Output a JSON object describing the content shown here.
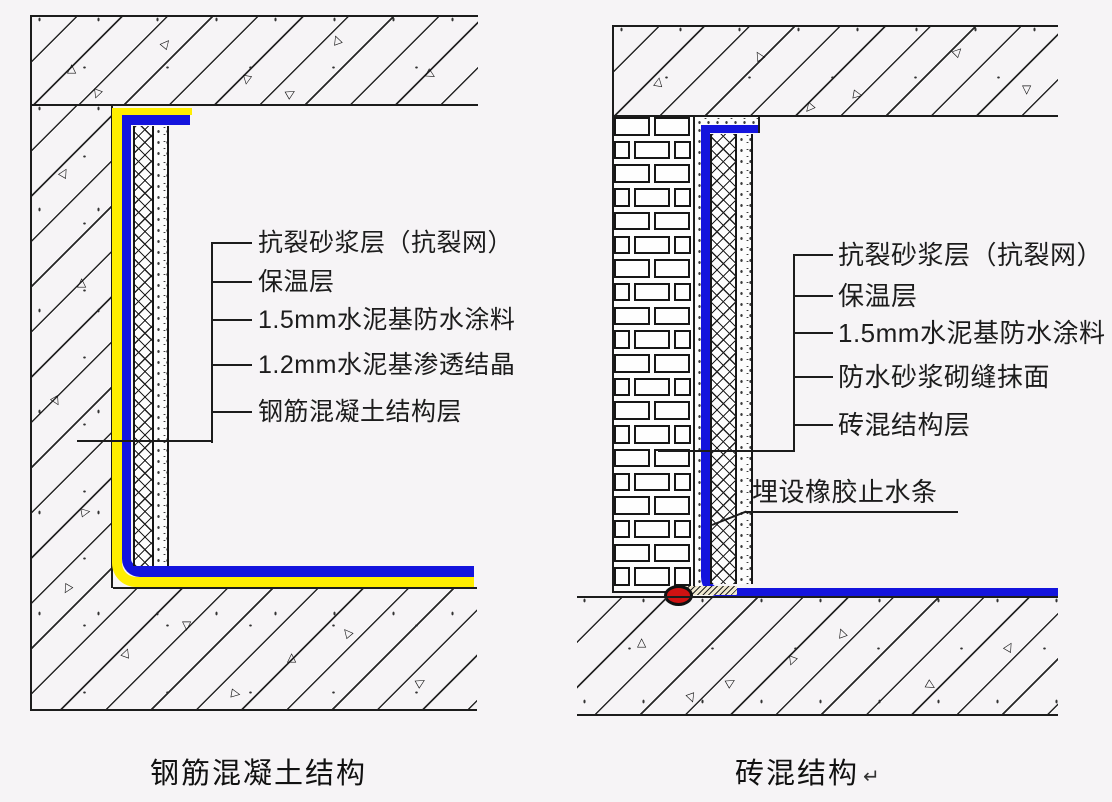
{
  "page": {
    "background": "#f6f4f6"
  },
  "colors": {
    "line_black": "#1c1c1c",
    "waterproof_blue": "#1414dd",
    "coating_yellow": "#ffee00",
    "waterstop_red": "#cf1212"
  },
  "left_detail": {
    "caption": "钢筋混凝土结构",
    "labels": {
      "anti_crack": "抗裂砂浆层（抗裂网）",
      "insulation": "保温层",
      "waterproof_coating": "1.5mm水泥基防水涂料",
      "crystalline": "1.2mm水泥基渗透结晶",
      "structure": "钢筋混凝土结构层"
    }
  },
  "right_detail": {
    "caption": "砖混结构",
    "caption_mark": "↵",
    "labels": {
      "anti_crack": "抗裂砂浆层（抗裂网）",
      "insulation": "保温层",
      "waterproof_coating": "1.5mm水泥基防水涂料",
      "mortar_joint": "防水砂浆砌缝抹面",
      "structure": "砖混结构层"
    },
    "callout": "埋设橡胶止水条"
  }
}
